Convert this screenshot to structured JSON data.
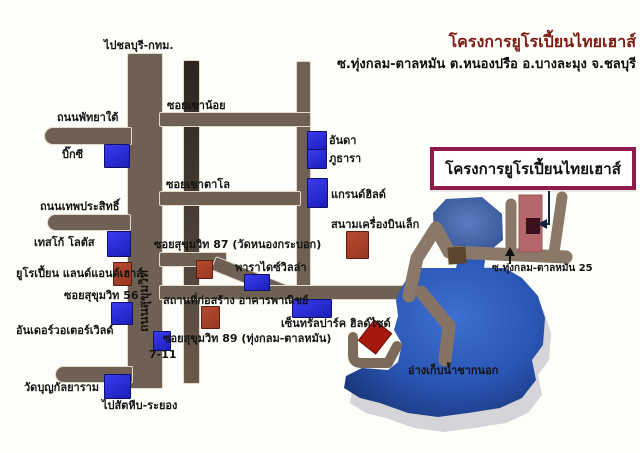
{
  "map": {
    "header": {
      "title": "โครงการยูโรเปี้ยนไทยเฮาส์",
      "subtitle": "ซ.ทุ่งกลม-ตาลหมัน ต.หนองปรือ อ.บางละมุง จ.ชลบุรี"
    },
    "project_box_label": "โครงการยูโรเปี้ยนไทยเฮาส์",
    "roads": {
      "to_chonburi": "ไปชลบุรี-กทม.",
      "sukhumvit": "ถนนสุขุมวิท",
      "pattaya_tai": "ถนนพัทยาใต้",
      "thep_prasit": "ถนนเทพประสิทธิ์",
      "soi_khao_noi": "ซอยเขาน้อย",
      "soi_khao_talo": "ซอยเขาตาโล",
      "soi_56": "ซอยสุขุมวิท 56",
      "soi_87": "ซอยสุขุมวิท 87 (วัดหนองกระบอก)",
      "soi_89": "ซอยสุขุมวิท 89 (ทุ่งกลม-ตาลหมัน)",
      "soi_25": "ซ.ทุ่งกลม-ตาลหมัน 25",
      "to_sattahip": "ไปสัตหีบ-ระยอง"
    },
    "places": {
      "big_c": "บิ๊กซี",
      "tesco_lotus": "เทสโก้ โลตัส",
      "european_land_house": "ยูโรเปี้ยน แลนด์แอนด์เฮาส์",
      "underwater_world": "อันเดอร์วอเตอร์เวิลด์",
      "wat_boon": "วัดบุญกัลยาราม",
      "seven_eleven": "7-11",
      "paradise_villa": "พาราไดซ์วิลล่า",
      "construction_site": "สถานที่ก่อสร้าง อาคารพาณิชย์",
      "anda": "อันดา",
      "phu_thara": "ภูธารา",
      "grand_hill": "แกรนด์ฮิลด์",
      "airfield": "สนามเครื่องบินเล็ก",
      "central_park_hillside": "เซ็นทรัลปาร์ค ฮิลด์ไซด์",
      "reservoir": "อ่างเก็บน้ำชากนอก"
    },
    "colors": {
      "road": "#6e6053",
      "road_dark": "#2a2520",
      "road_light": "#8a7868",
      "marker_blue": "#2426d4",
      "marker_red": "#a8402a",
      "project_strip_red": "#b4666b",
      "lake_blue": "#2a55b4",
      "lake_shadow": "#d5d5d9",
      "sign_border": "#8e1b4c",
      "header_red": "#7d1a12"
    }
  }
}
